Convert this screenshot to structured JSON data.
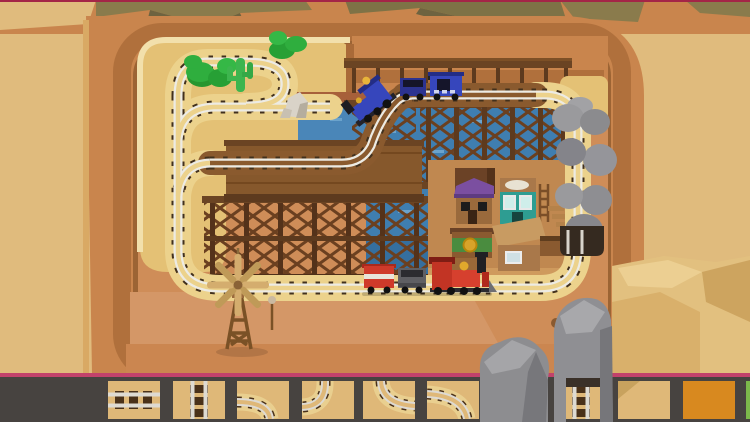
{
  "meta": {
    "app": "train-track-building-game",
    "scene": "desert-canyon-level",
    "canvas": {
      "width": 750,
      "height": 422
    }
  },
  "palette": {
    "mesa_tan": "#e0bb7d",
    "canyon_wall": "#c9854d",
    "canyon_wall_mid": "#b0703c",
    "canyon_wall_dark": "#9c6434",
    "pit_floor_pink": "#cf8d58",
    "plateau_sand": "#e4c175",
    "track_bed_sand": "#ecd28c",
    "rail_white": "#edebe3",
    "sleeper_brown": "#42301c",
    "water_blue": "#3f7eb0",
    "water_deep": "#356f9f",
    "wood_dark": "#5d3a1e",
    "wood_mid": "#6b4423",
    "deck_brown": "#86582c",
    "rock_gray": "#8d8d90",
    "rock_gray_light": "#a5a5a8",
    "rock_gray_dark": "#77777b",
    "bush_green": "#2fae3e",
    "cactus_green": "#3db54e",
    "train_blue": "#3646bc",
    "train_red": "#d6402e",
    "windmill_wood": "#d4ad6e",
    "town_purple_roof": "#7b4fa0",
    "town_teal": "#2e9d92",
    "coin_gold": "#d8a32a",
    "toolbar_bg": "#474340",
    "accent_pink": "#c2426b",
    "top_line_red": "#a42547",
    "tile_sand": "#dfb878",
    "tile_orange": "#d8891f",
    "tile_green_edge": "#7cb84b"
  },
  "scene": {
    "terrain": "sunken desert canyon with olive ridge at top, tan mesas left and right",
    "water": "canyon-pond",
    "trains": [
      {
        "id": "blue-train",
        "color": "#3646bc",
        "cars": [
          "locomotive",
          "tender",
          "boxcar"
        ],
        "location": "upper-trestle-track"
      },
      {
        "id": "red-train",
        "color": "#d6402e",
        "cars": [
          "boxcar",
          "tender",
          "locomotive"
        ],
        "location": "bottom-straight-track"
      }
    ],
    "structures": [
      "wooden-trestle-bridge",
      "wooden-deck",
      "windmill",
      "western-town",
      "signpost"
    ],
    "town_buildings": [
      "water-tank",
      "purple-roof-house",
      "teal-storefront",
      "gold-coin-bank",
      "awning-shed",
      "ladder",
      "stairs"
    ],
    "vegetation": {
      "bushes": 2,
      "cacti": 1
    },
    "rocks": [
      "white-rock-plateau",
      "right-boulder-tunnel",
      "bottom-rock-left",
      "bottom-rock-arch",
      "pebbles"
    ]
  },
  "toolbar": {
    "tiles": [
      {
        "id": "tile-1",
        "kind": "straight-h",
        "x": 108,
        "w": 52
      },
      {
        "id": "tile-2",
        "kind": "straight-v",
        "x": 173,
        "w": 52
      },
      {
        "id": "tile-3",
        "kind": "curve-left-bottom",
        "x": 237,
        "w": 52
      },
      {
        "id": "tile-4",
        "kind": "curve-top-left",
        "x": 302,
        "w": 52
      },
      {
        "id": "tile-5",
        "kind": "curve-top-right",
        "x": 363,
        "w": 52
      },
      {
        "id": "tile-6",
        "kind": "curve-left-bottom-wide",
        "x": 427,
        "w": 52
      },
      {
        "id": "tile-7",
        "kind": "hidden-under-rock",
        "x": 491,
        "w": 52
      },
      {
        "id": "tile-8",
        "kind": "straight-v",
        "x": 555,
        "w": 52
      },
      {
        "id": "tile-9",
        "kind": "empty-sand",
        "x": 618,
        "w": 52
      },
      {
        "id": "tile-10",
        "kind": "orange-special",
        "x": 683,
        "w": 52
      },
      {
        "id": "tile-11",
        "kind": "green-edge",
        "x": 746,
        "w": 4
      }
    ]
  }
}
